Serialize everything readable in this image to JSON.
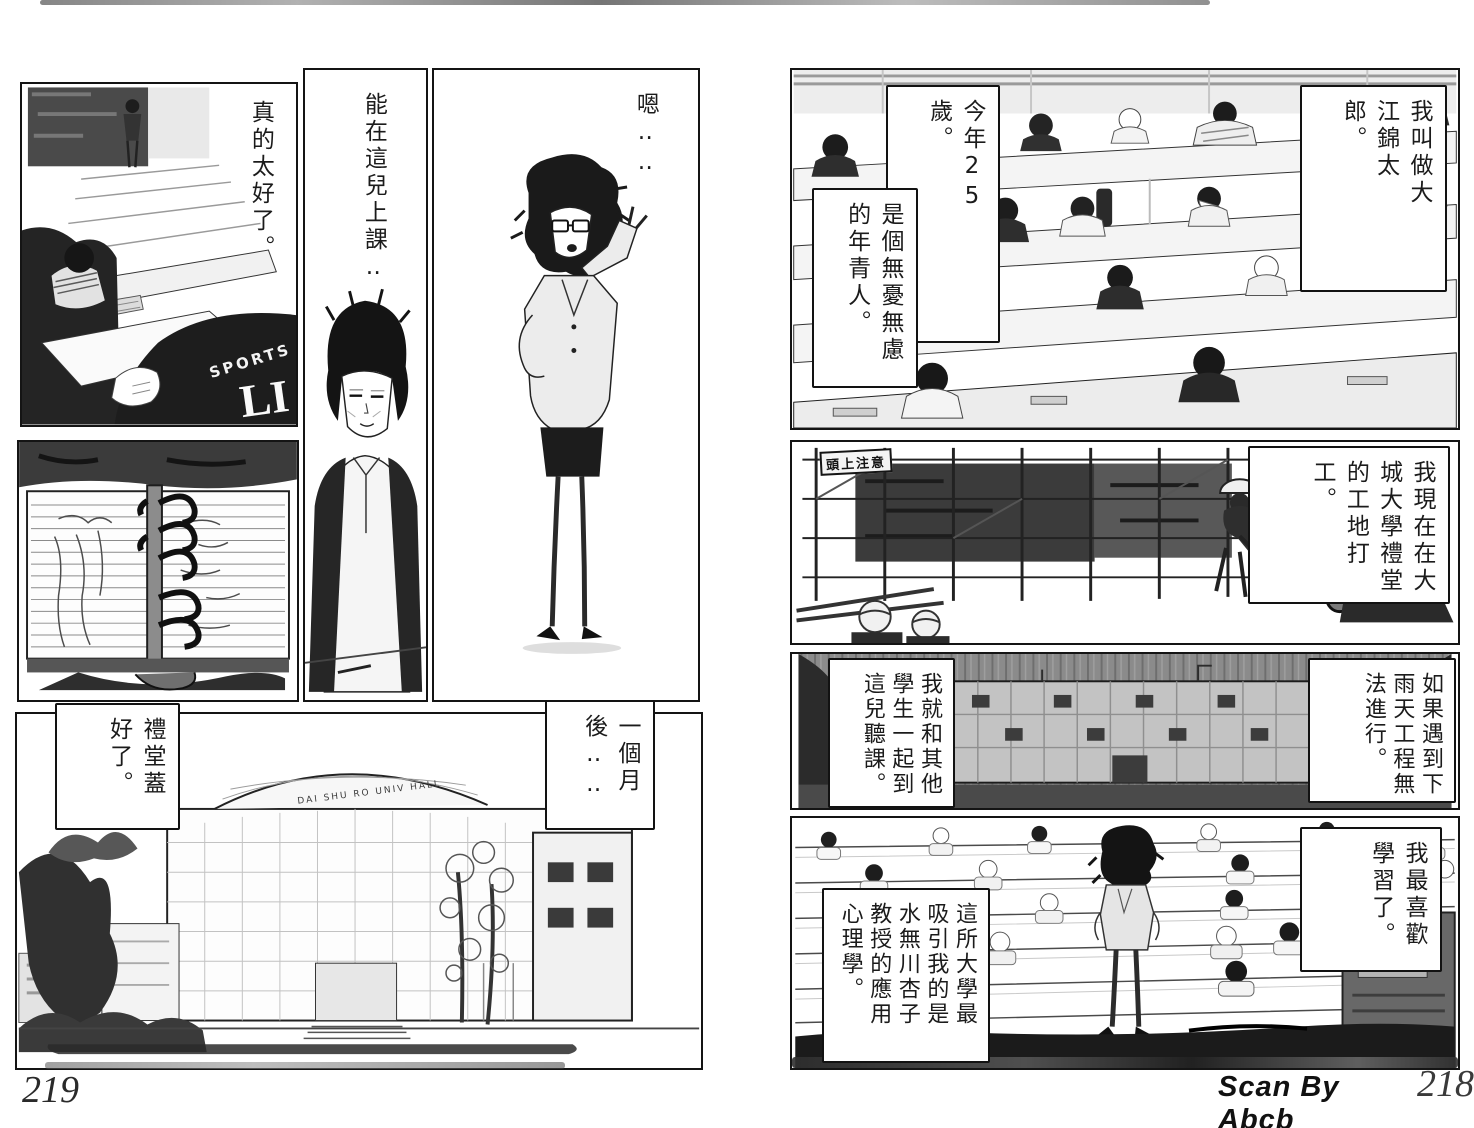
{
  "colors": {
    "ink": "#1a1a1a",
    "paper": "#ffffff"
  },
  "left_page": {
    "page_number": "219",
    "panel_classroom": {
      "caption": "真的太好了。",
      "jacket_line1": "SPORTS",
      "jacket_line2": "LI"
    },
    "panel_portrait": {
      "caption": "能在這兒上課‥"
    },
    "panel_teacher": {
      "caption": "嗯‥‥"
    },
    "panel_notebook": {},
    "panel_hall_exterior": {
      "bubble_left": "禮堂蓋好了。",
      "bubble_right": "一個月後‥‥",
      "building_sign": "DAI SHU RO UNIV HALL"
    }
  },
  "right_page": {
    "page_number": "218",
    "scan_credit": "Scan By Abcb",
    "panel_lecture_top": {
      "caption_name": "我叫做大江錦太郎。",
      "caption_age": "今年25歲。",
      "caption_person": "是個無憂無慮的年青人。"
    },
    "panel_construction": {
      "caption": "我現在在大城大學禮堂的工地打工。",
      "sign": "頭上注意"
    },
    "panel_rain": {
      "caption_right": "如果遇到下雨天工程無法進行。",
      "caption_left": "我就和其他學生一起到這兒聽課。"
    },
    "panel_lecture_bottom": {
      "caption_right": "我最喜歡學習了。",
      "caption_left": "這所大學最吸引我的是水無川杏子教授的應用心理學。"
    }
  }
}
